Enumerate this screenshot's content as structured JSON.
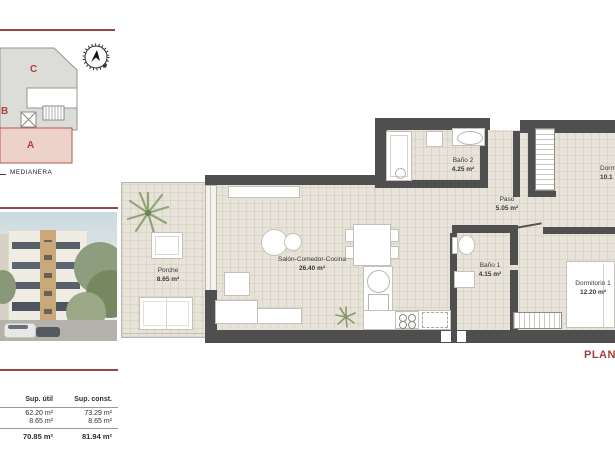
{
  "colors": {
    "accent_red": "#8f4a47",
    "plan_title_red": "#9c423e",
    "wall_gray": "#4f4f4f",
    "floor_beige": "#e7e3d9",
    "section_letter_red": "#b0413a",
    "highlight_pink": "#edd2cc"
  },
  "key_plan": {
    "compass_icon": "north-arrow",
    "sections": [
      {
        "label": "C"
      },
      {
        "label": "B"
      },
      {
        "label": "A"
      }
    ],
    "medianera_label": "MEDIANERA"
  },
  "areas_table": {
    "col_headers": [
      "Sup. útil",
      "Sup. const."
    ],
    "rows": [
      [
        "62.20 m²",
        "73.29 m²"
      ],
      [
        "8.65 m²",
        "8.65 m²"
      ]
    ],
    "totals": [
      "70.85 m²",
      "81.94 m²"
    ]
  },
  "floor_plan": {
    "rooms": [
      {
        "name": "Porche",
        "area": "8.65 m²"
      },
      {
        "name": "Salón-Comedor-Cocina",
        "area": "26.40 m²"
      },
      {
        "name": "Baño 2",
        "area": "4.25 m²"
      },
      {
        "name": "Paso",
        "area": "5.05 m²"
      },
      {
        "name": "Baño 1",
        "area": "4.15 m²"
      },
      {
        "name": "Dormitorio 1",
        "area": "12.20 m²"
      },
      {
        "name": "Dorm",
        "area": "10.1"
      }
    ]
  },
  "footer": {
    "plan_title_fragment": "PLANT"
  }
}
